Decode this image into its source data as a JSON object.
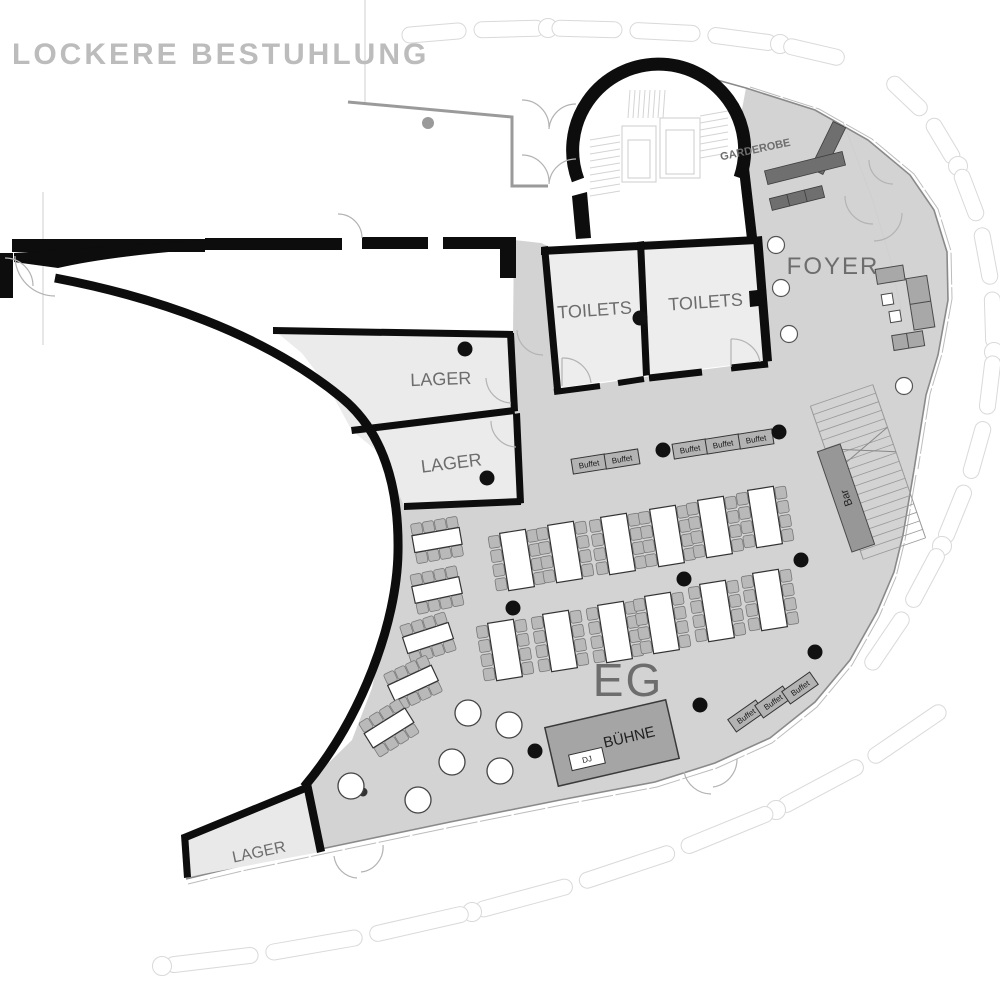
{
  "title": "LOCKERE BESTUHLUNG",
  "floor": {
    "label": "EG"
  },
  "rooms": {
    "garderobe": "GARDEROBE",
    "foyer": "FOYER",
    "toilets_left": "TOILETS",
    "toilets_right": "TOILETS",
    "lager_upper": "LAGER",
    "lager_lower": "LAGER",
    "lager_south": "LAGER"
  },
  "stage": {
    "label": "BÜHNE",
    "dj_label": "DJ"
  },
  "bar": {
    "label": "Bar"
  },
  "buffet": {
    "label": "Buffet",
    "groups": [
      {
        "tables": 2
      },
      {
        "tables": 3
      },
      {
        "tables": 3
      }
    ]
  },
  "furniture": {
    "long_tables": 17,
    "seats_per_long_table": 8,
    "standing_tables": 6,
    "column_dots": 12,
    "foyer_columns": 4
  },
  "colors": {
    "hall": "#d3d3d3",
    "room": "#ebebeb",
    "wall": "#0d0d0d",
    "stage": "#a5a5a5",
    "rack": "#6f6f6f",
    "sofa": "#a8a8a8",
    "buffet_table": "#b3b3b3",
    "chair": "#b9b9b9",
    "facade": "#8a8a8a",
    "hedge": "#d9d9d9",
    "title": "#bcbcbc",
    "label": "#6d6d6d"
  }
}
